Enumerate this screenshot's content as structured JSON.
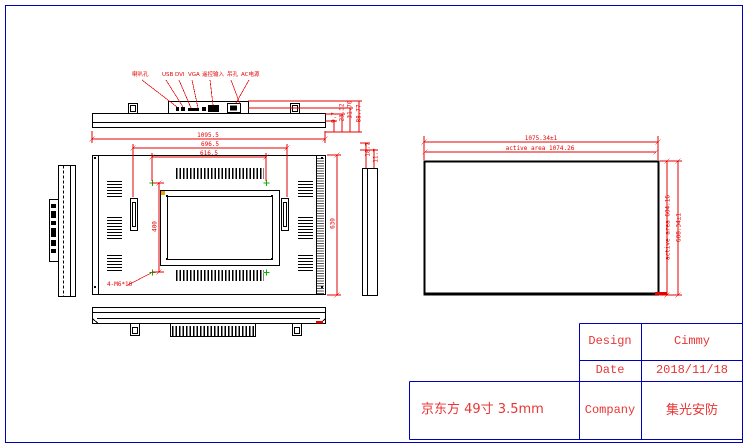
{
  "colors": {
    "outline": "#000000",
    "dimension_red": "#e60000",
    "table_blue": "#0000bb",
    "marker_green": "#00b400",
    "marker_orange": "#f0a000"
  },
  "top_view": {
    "connector_labels": [
      "喇叭孔",
      "USB",
      "DVI",
      "VGA",
      "遥控输入",
      "吊孔",
      "AC电源"
    ],
    "thickness_dims": [
      "9.7",
      "23.32",
      "31.70",
      "88.77"
    ]
  },
  "panel_edge_dims": [
    "18.7",
    "11.7"
  ],
  "back_view": {
    "overall_width": "1095.5",
    "handle_spacing": "696.5",
    "vesa_width": "616.5",
    "vesa_height": "400",
    "overall_height": "630",
    "mount_holes": "4-M6*10"
  },
  "front_view": {
    "outline_width": "1075.34±1",
    "active_width": "active area 1074.26",
    "active_height": "active area 604.16",
    "outline_height": "608.34±1"
  },
  "title_block": {
    "product": "京东方 49寸 3.5mm",
    "rows": [
      {
        "label": "Design",
        "value": "Cimmy"
      },
      {
        "label": "Date",
        "value": "2018/11/18"
      },
      {
        "label": "Company",
        "value": "集光安防"
      }
    ]
  }
}
